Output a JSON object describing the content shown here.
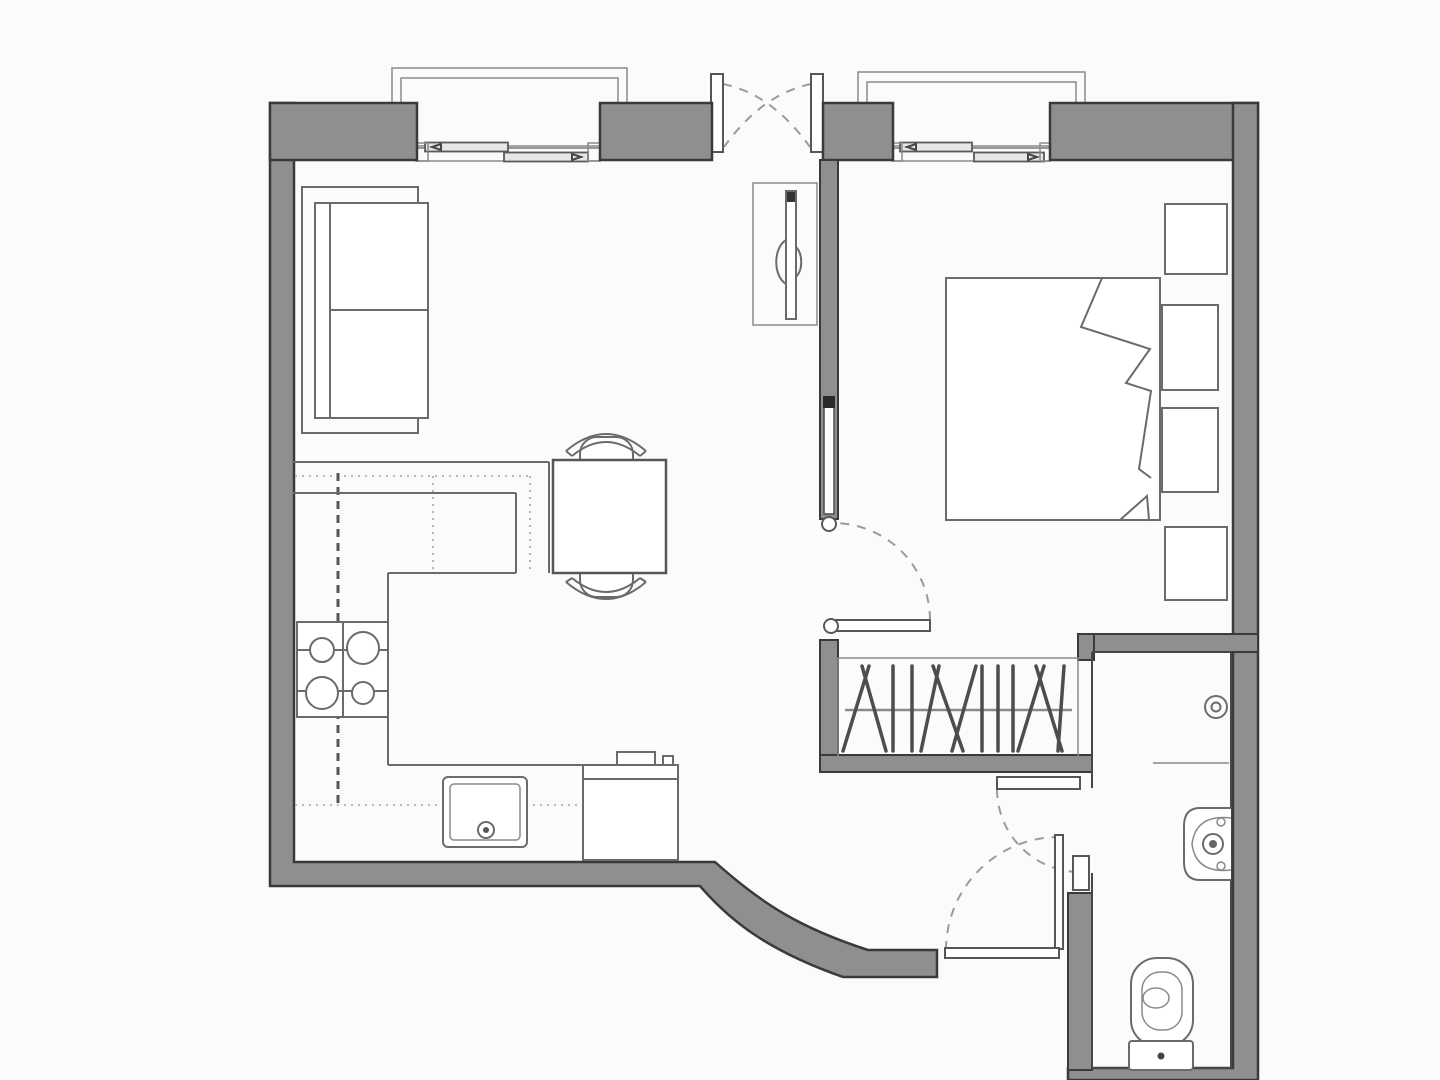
{
  "palette": {
    "background": "#fbfbfa",
    "wall_fill": "#8f8f8f",
    "wall_outline": "#3a3a3a",
    "line": "#6b6b6b",
    "line_light": "#8a8a8a",
    "dash": "#9b9b9b",
    "dots": "#a5a5a5",
    "white": "#ffffff"
  },
  "plan": {
    "kind": "apartment-floor-plan",
    "rooms": [
      {
        "name": "living-room",
        "fixtures": [
          "sofa-two-seat"
        ]
      },
      {
        "name": "kitchen",
        "fixtures": [
          "l-shaped-counter",
          "stove-4-burner",
          "kitchen-sink",
          "washing-machine",
          "dining-table",
          "dining-chair-top",
          "dining-chair-bottom"
        ]
      },
      {
        "name": "hallway",
        "fixtures": [
          "hall-cabinet-with-mirror"
        ]
      },
      {
        "name": "bedroom",
        "fixtures": [
          "double-bed-with-folded-blanket",
          "nightstand-top",
          "shelf-upper",
          "shelf-lower",
          "nightstand-bottom"
        ]
      },
      {
        "name": "wardrobe-closet",
        "fixtures": [
          "hanger-rod",
          "clothes-hangers"
        ]
      },
      {
        "name": "bathroom",
        "fixtures": [
          "downlight",
          "shower-divider",
          "wash-basin",
          "toilet"
        ]
      }
    ],
    "windows": [
      {
        "name": "living-room-window",
        "panes": 2,
        "balcony_outline": true
      },
      {
        "name": "bedroom-window",
        "panes": 2,
        "balcony_outline": true
      }
    ],
    "doors": [
      {
        "name": "entry-double-door",
        "type": "double-swing"
      },
      {
        "name": "bedroom-door",
        "type": "swing"
      },
      {
        "name": "bathroom-door",
        "type": "swing"
      },
      {
        "name": "lobby-door",
        "type": "swing"
      }
    ]
  },
  "stove": {
    "burners": [
      {
        "cx": 322,
        "cy": 650,
        "r": 12
      },
      {
        "cx": 363,
        "cy": 648,
        "r": 16
      },
      {
        "cx": 322,
        "cy": 693,
        "r": 16
      },
      {
        "cx": 363,
        "cy": 693,
        "r": 11
      }
    ]
  },
  "closet": {
    "hanger_count": 13,
    "rod_y": 710,
    "hangers": [
      {
        "x": 856,
        "tilt": 13
      },
      {
        "x": 874,
        "tilt": -12
      },
      {
        "x": 893,
        "tilt": 0
      },
      {
        "x": 912,
        "tilt": 0
      },
      {
        "x": 930,
        "tilt": 9
      },
      {
        "x": 948,
        "tilt": -15
      },
      {
        "x": 964,
        "tilt": 12
      },
      {
        "x": 982,
        "tilt": 0
      },
      {
        "x": 998,
        "tilt": 0
      },
      {
        "x": 1013,
        "tilt": 0
      },
      {
        "x": 1031,
        "tilt": 13
      },
      {
        "x": 1049,
        "tilt": -13
      },
      {
        "x": 1061,
        "tilt": 3
      }
    ]
  }
}
